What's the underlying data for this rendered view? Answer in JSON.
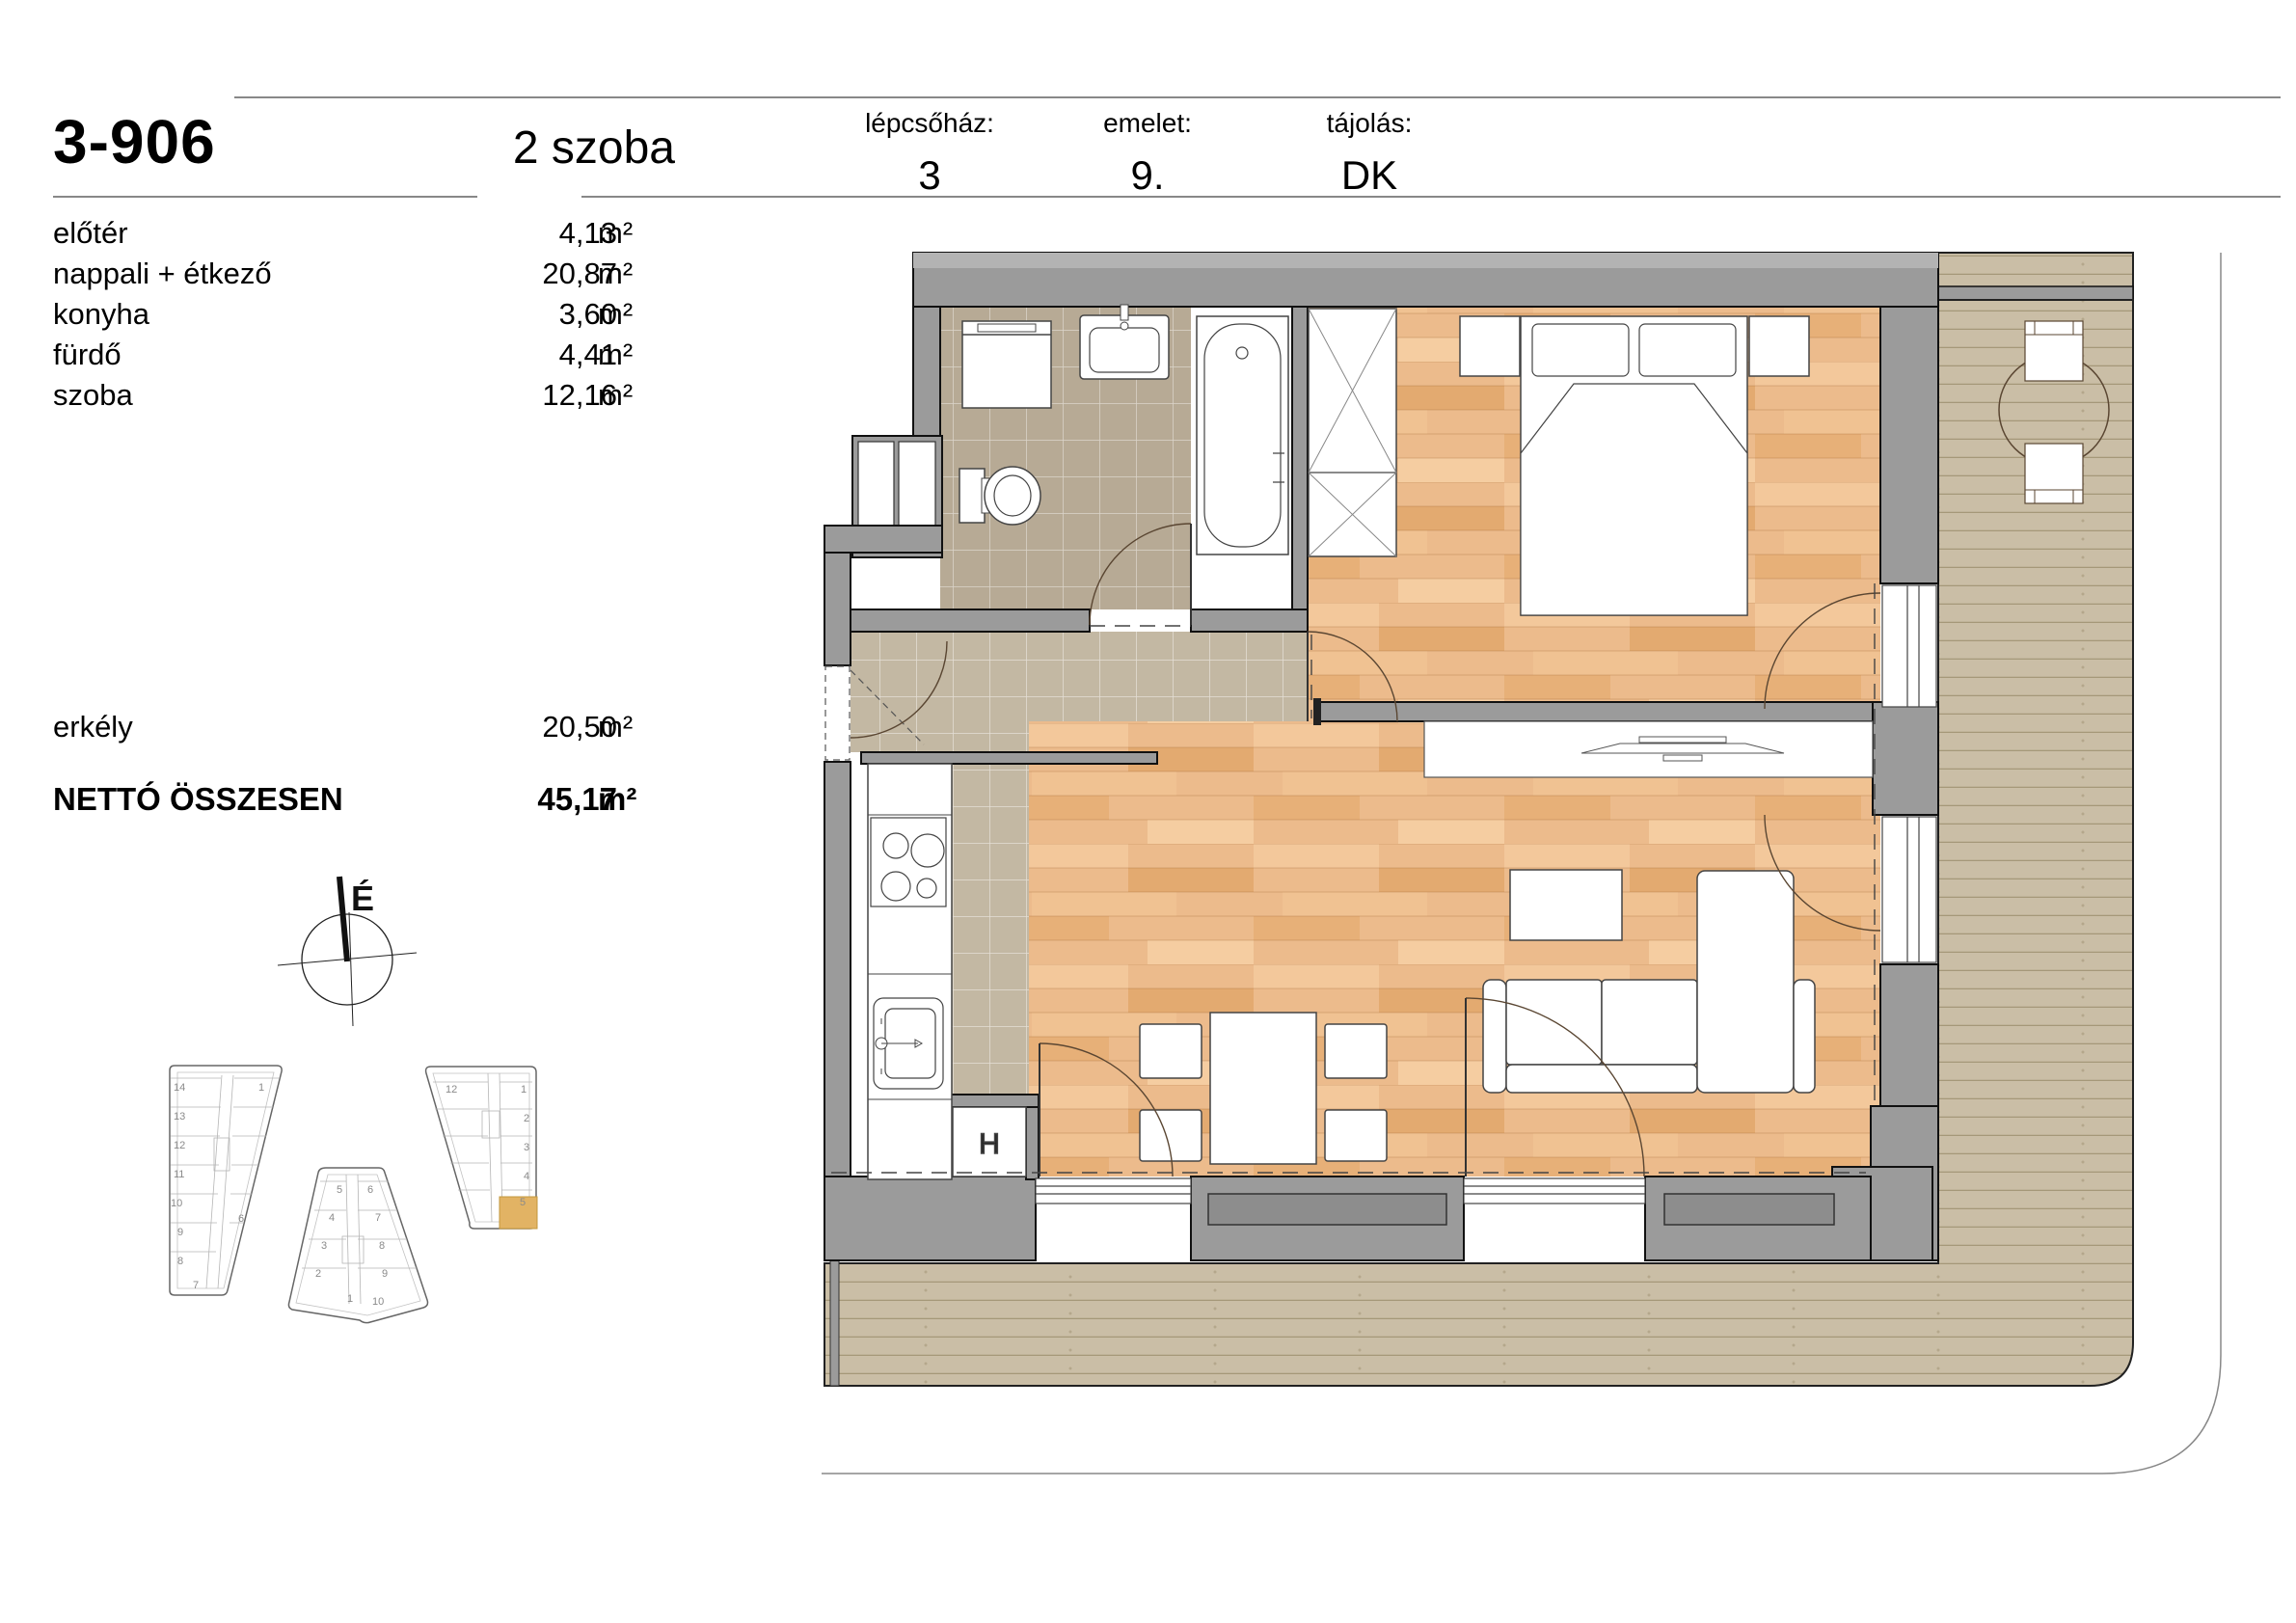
{
  "info_panel": {
    "unit_id": "3-906",
    "unit_type": "2 szoba",
    "rooms": [
      {
        "name": "előtér",
        "area": "4,13",
        "unit": "m²"
      },
      {
        "name": "nappali + étkező",
        "area": "20,87",
        "unit": "m²"
      },
      {
        "name": "konyha",
        "area": "3,60",
        "unit": "m²"
      },
      {
        "name": "fürdő",
        "area": "4,41",
        "unit": "m²"
      },
      {
        "name": "szoba",
        "area": "12,16",
        "unit": "m²"
      }
    ],
    "balcony_row": {
      "name": "erkély",
      "area": "20,50",
      "unit": "m²"
    },
    "total_row": {
      "name": "NETTÓ ÖSSZESEN",
      "area": "45,17",
      "unit": "m²"
    }
  },
  "header": {
    "fields": [
      {
        "label": "lépcsőház:",
        "value": "3"
      },
      {
        "label": "emelet:",
        "value": "9."
      },
      {
        "label": "tájolás:",
        "value": "DK"
      }
    ]
  },
  "compass": {
    "label": "É"
  },
  "floor_plan": {
    "storage_label": "H",
    "colors": {
      "wall": "#9b9b9b",
      "bath_tile": "#b7aa95",
      "hall_tile": "#c3b8a3",
      "wood_floor": "#ecbb8c",
      "deck": "#cabea6",
      "highlight": "#e2b364"
    }
  },
  "site_plan": {
    "highlight_color": "#e2b364",
    "highlighted_unit_building": "C",
    "buildings": [
      {
        "id": "A",
        "units": [
          {
            "n": "14"
          },
          {
            "n": "13"
          },
          {
            "n": "12"
          },
          {
            "n": "11"
          },
          {
            "n": "10"
          },
          {
            "n": "9"
          },
          {
            "n": "8"
          },
          {
            "n": "7"
          },
          {
            "n": "1"
          },
          {
            "n": "6"
          }
        ]
      },
      {
        "id": "B",
        "units": [
          {
            "n": "5"
          },
          {
            "n": "6"
          },
          {
            "n": "4"
          },
          {
            "n": "7"
          },
          {
            "n": "3"
          },
          {
            "n": "8"
          },
          {
            "n": "2"
          },
          {
            "n": "9"
          },
          {
            "n": "1"
          },
          {
            "n": "10"
          }
        ]
      },
      {
        "id": "C",
        "units": [
          {
            "n": "12"
          },
          {
            "n": "1"
          },
          {
            "n": "2"
          },
          {
            "n": "3"
          },
          {
            "n": "4"
          },
          {
            "n": "5"
          }
        ]
      }
    ]
  }
}
